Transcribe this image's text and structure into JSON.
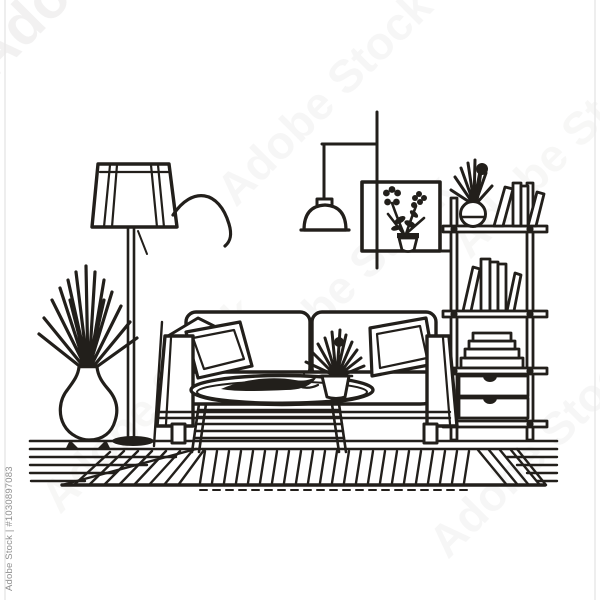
{
  "image": {
    "kind": "stock line-art illustration",
    "subject": "minimalist living room interior in continuous black line style"
  },
  "colors": {
    "line": "#221f1b",
    "bg": "#ffffff",
    "border": "#e9e9e9",
    "watermark": "#8f8f8f"
  },
  "watermark": {
    "side_text": "Adobe Stock | #1030897083",
    "tile_text": "Adobe Stock"
  },
  "scene": {
    "objects": [
      "floor lamp with arc arm",
      "spiky potted plant in round vase",
      "two-seat sofa with throw pillows",
      "oval coffee table with slatted shelf, decor and small plant",
      "pendant ceiling lamp",
      "square wall frame with flower pot silhouette",
      "ladder bookshelf with plant, books, stacked books and two drawers",
      "striped area rug"
    ]
  }
}
